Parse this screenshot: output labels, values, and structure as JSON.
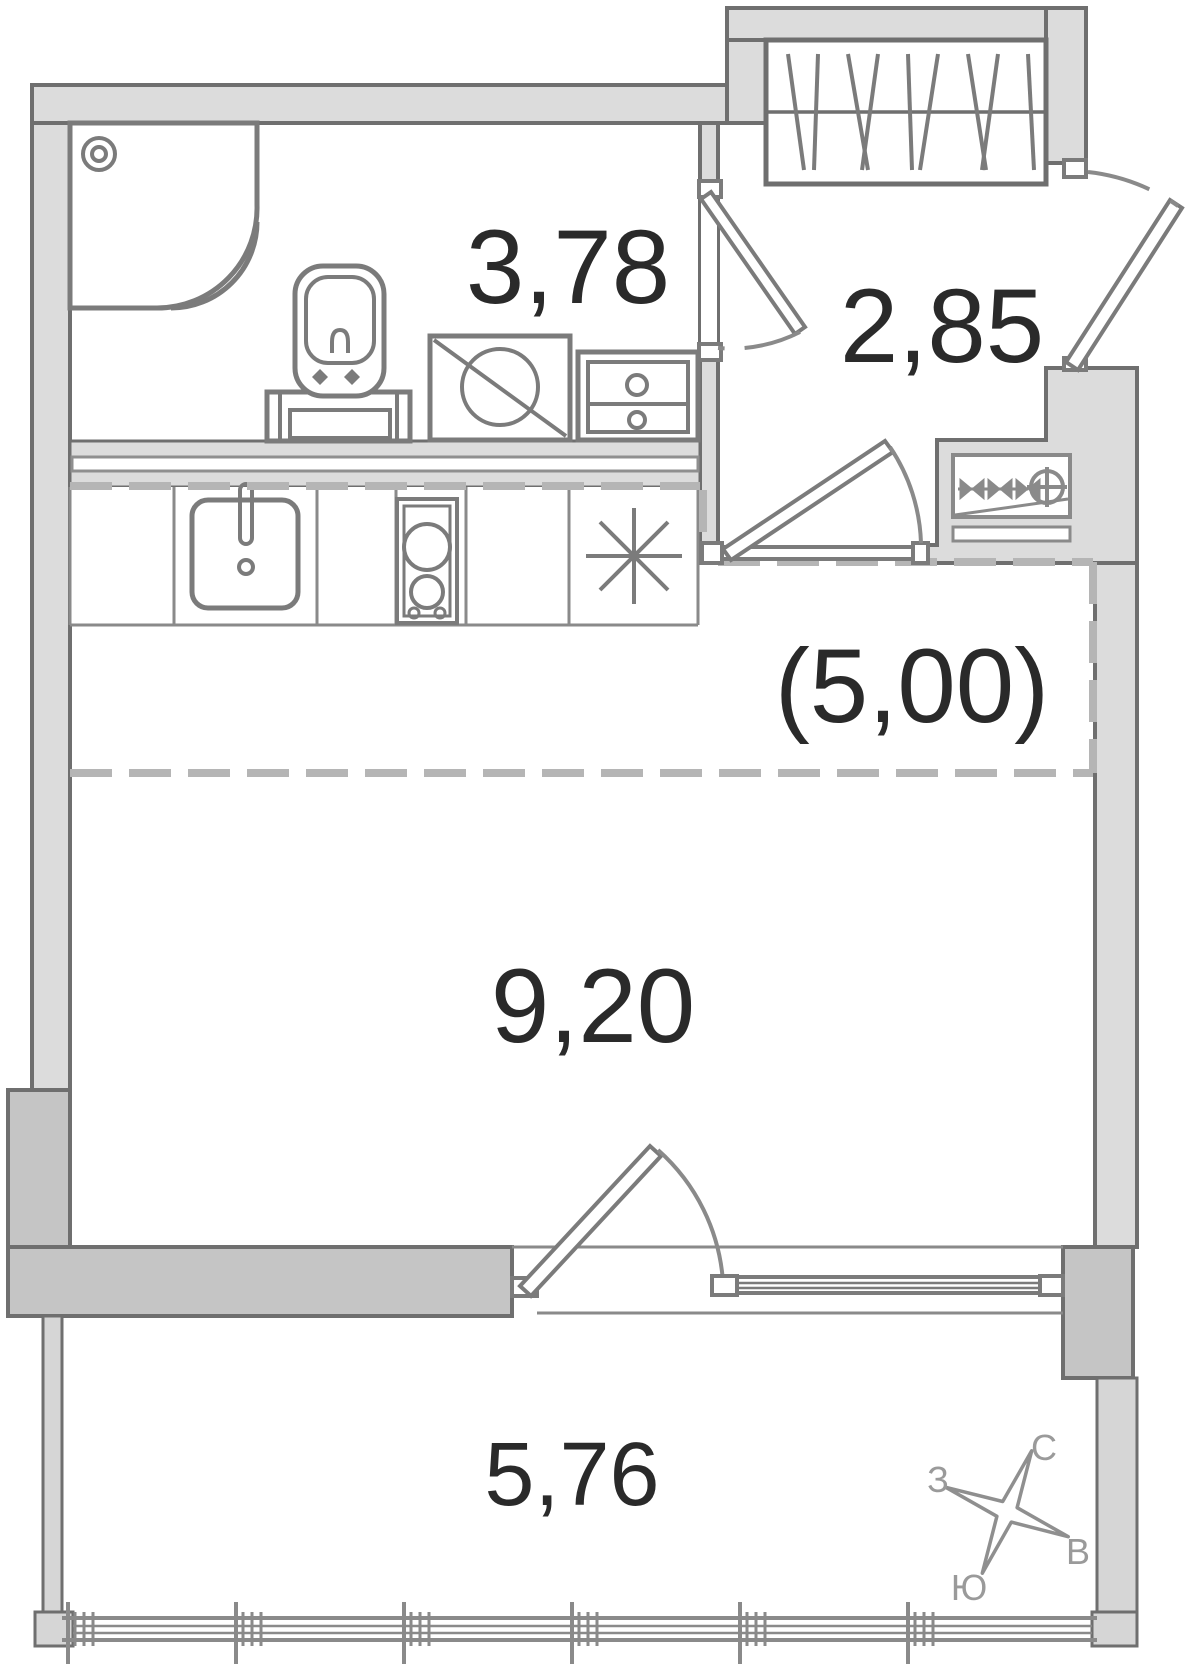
{
  "plan": {
    "type": "apartment-floor-plan",
    "rooms": {
      "bathroom": {
        "area": "3,78"
      },
      "hallway": {
        "area": "2,85"
      },
      "kitchen_zone": {
        "area": "(5,00)"
      },
      "living_room": {
        "area": "9,20"
      },
      "balcony": {
        "area": "5,76"
      }
    },
    "compass": {
      "north": "С",
      "west": "З",
      "east": "В",
      "south": "Ю"
    },
    "colors": {
      "wall_fill": "#dcdcdc",
      "wall_fill_dark": "#c5c5c5",
      "balcony_wall_fill": "#d6d6d6",
      "wall_outline": "#6f6f6f",
      "fixture_stroke": "#7b7b7b",
      "thin_line": "#8a8a8a",
      "dashed_zone_line": "#b5b5b5",
      "label_text": "#2a2a2a",
      "compass_text": "#9a9a9a"
    }
  }
}
